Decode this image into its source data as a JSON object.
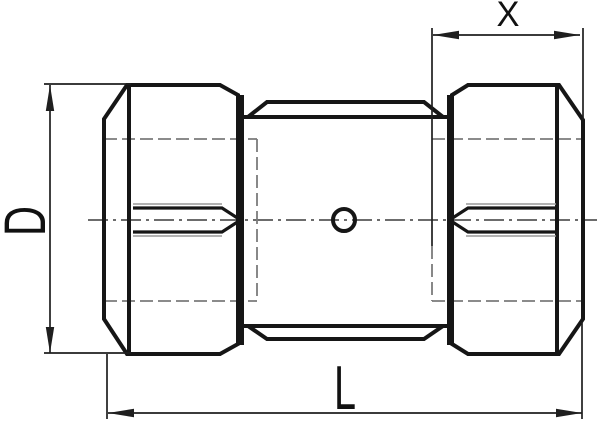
{
  "labels": {
    "diameter": "D",
    "overall_length": "L",
    "insertion_depth": "X"
  },
  "colors": {
    "background": "#ffffff",
    "outline": "#161616",
    "dimension_lines": "#1f1f1f",
    "hidden_lines": "#7b7b7b",
    "thread_lines": "#999999",
    "centerline": "#3c3c3c"
  }
}
